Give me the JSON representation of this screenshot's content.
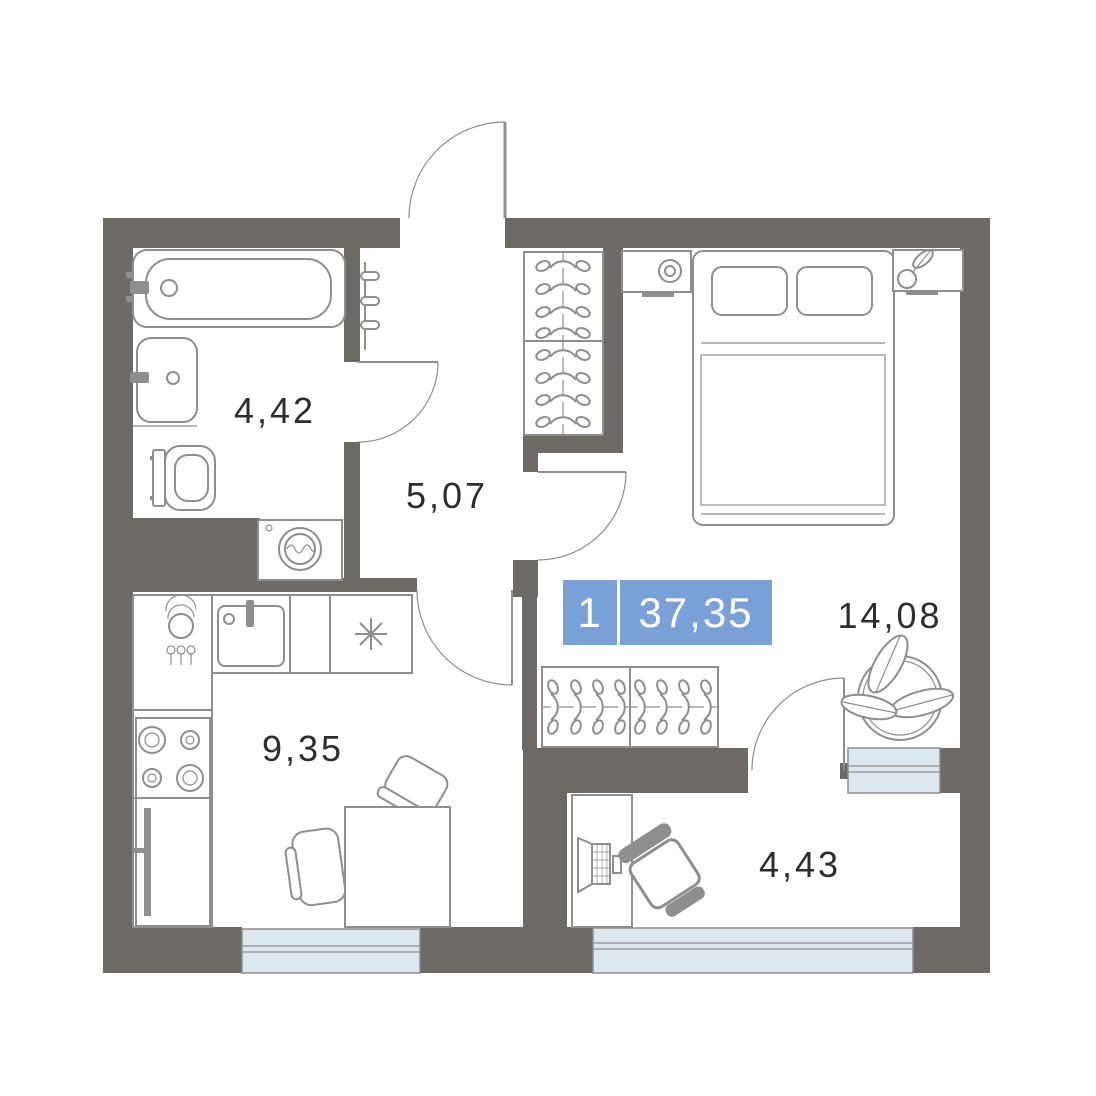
{
  "plan": {
    "type": "apartment-floor-plan",
    "badge": {
      "rooms_count": "1",
      "total_area": "37,35"
    },
    "rooms": [
      {
        "id": "bathroom",
        "area_label": "4,42"
      },
      {
        "id": "hallway",
        "area_label": "5,07"
      },
      {
        "id": "kitchen",
        "area_label": "9,35"
      },
      {
        "id": "living-room",
        "area_label": "14,08"
      },
      {
        "id": "loggia",
        "area_label": "4,43"
      }
    ],
    "icons": {
      "bathtub": "bathtub-top-view",
      "washbasin": "washbasin",
      "toilet": "toilet",
      "washing_machine": "washing-machine-drum",
      "towel_radiator": "towel-radiator",
      "hall_wardrobe": "clothes-hangers-rail",
      "living_wardrobe": "clothes-hangers-rail",
      "bed": "double-bed-with-pillows",
      "lamp": "bedside-lamp",
      "small_plant": "potted-plant",
      "large_plant": "potted-plant",
      "kitchen_sink": "kitchen-sink-with-tap",
      "dish_rack": "plate-stack",
      "cutlery": "cutlery-holder",
      "stove": "four-burner-stove",
      "fridge": "refrigerator",
      "stove_marker": "asterisk-marker",
      "dining_table": "dining-table",
      "dining_chairs": "chairs",
      "desk": "desk",
      "laptop": "laptop",
      "desk_chair": "office-chair"
    }
  },
  "colors": {
    "wall": "#6d6964",
    "line": "#8f8e8c",
    "window": "#dce7f0",
    "badge": "#7aa0d8",
    "text": "#2d2d2d"
  }
}
